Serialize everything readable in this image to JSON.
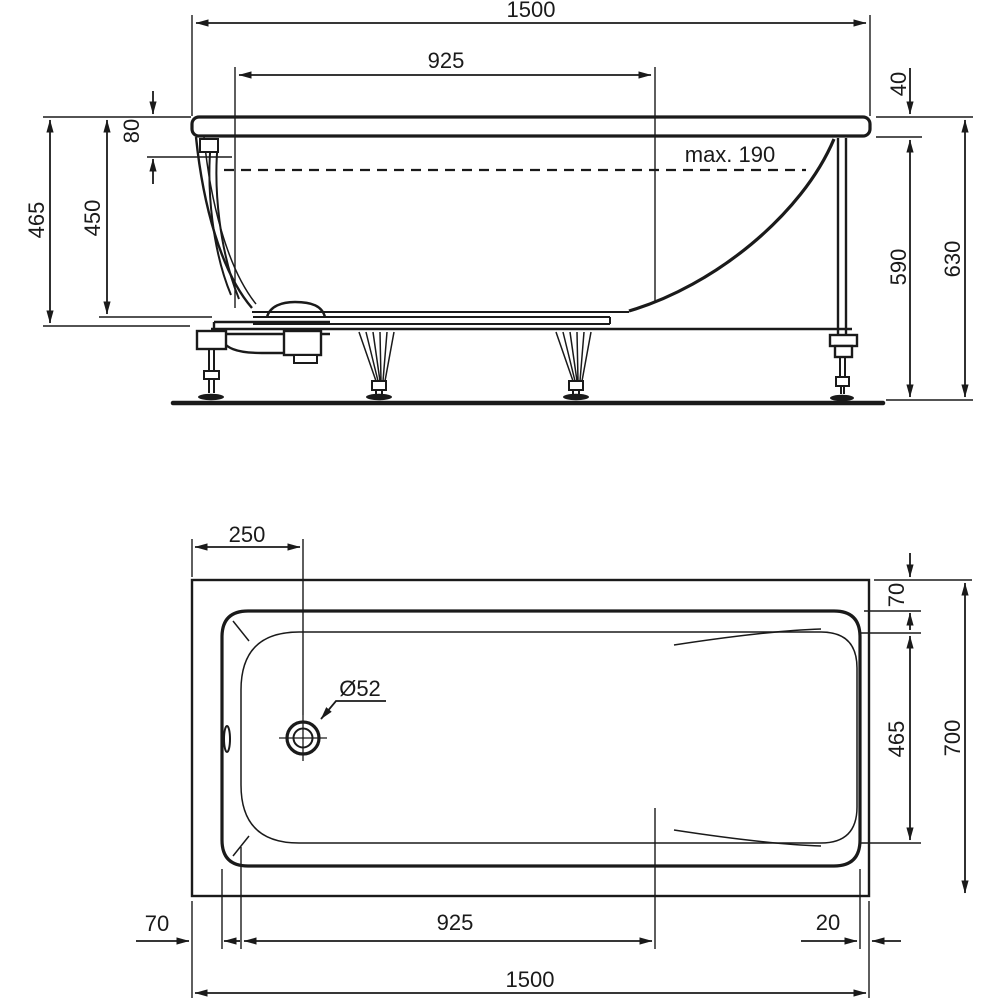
{
  "drawing": {
    "units": "mm",
    "line_color": "#1a1a1a",
    "background_color": "#ffffff",
    "side_view": {
      "dims": {
        "overall_length": "1500",
        "floor_length": "925",
        "rim_height": "40",
        "overflow_top_offset": "80",
        "max_fill_depth": "max. 190",
        "depth_to_support": "465",
        "inner_depth": "450",
        "underside_height": "590",
        "overall_height": "630"
      }
    },
    "plan_view": {
      "dims": {
        "drain_center_offset": "250",
        "drain_diameter": "Ø52",
        "top_rim_width": "70",
        "floor_width": "465",
        "overall_width": "700",
        "left_rim_width": "70",
        "floor_length": "925",
        "right_rim_width": "20",
        "overall_length": "1500"
      }
    }
  }
}
